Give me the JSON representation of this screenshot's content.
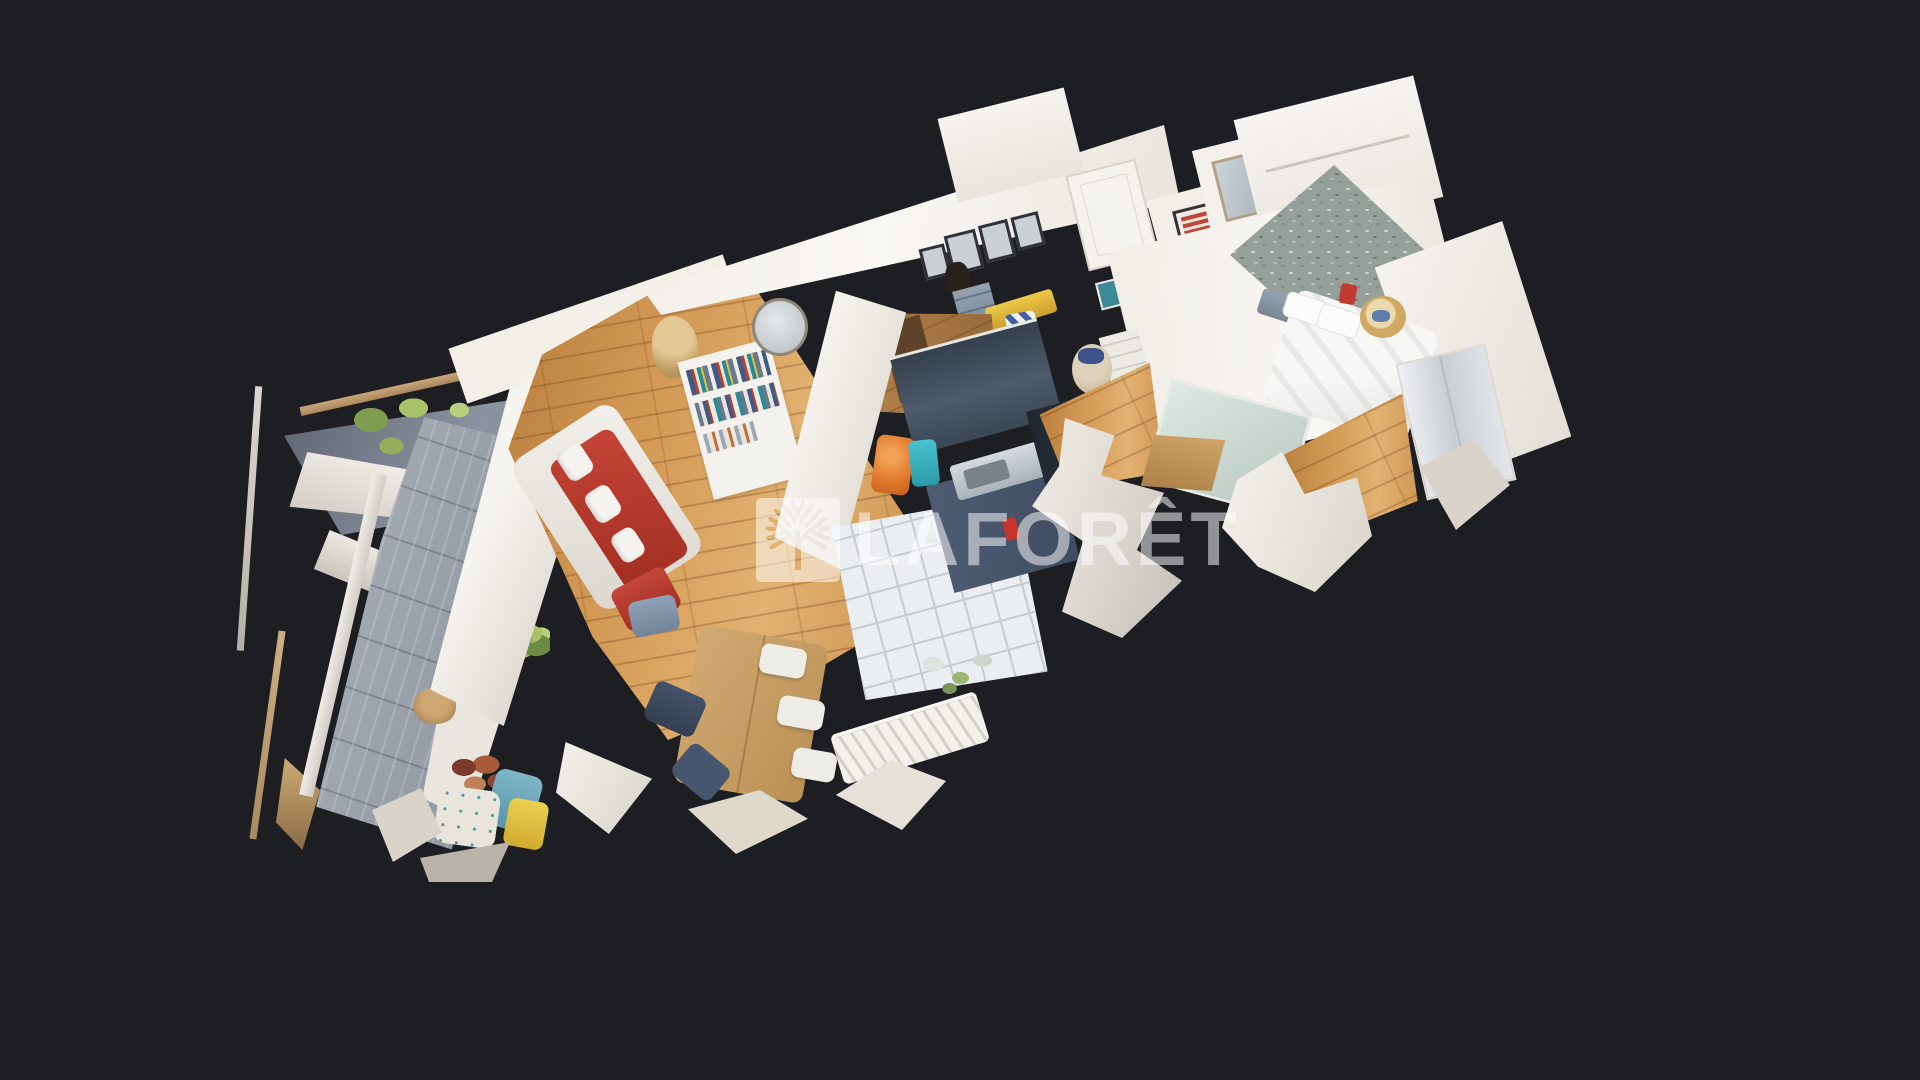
{
  "viewer": {
    "type": "3d-dollhouse-apartment-scan",
    "background_color": "#1d1e22"
  },
  "watermark": {
    "brand_text": "LAFORÊT",
    "icon": "laforet-tree-logo",
    "color": "#ffffff",
    "opacity": 0.52
  },
  "scene": {
    "rooms": [
      "balcony",
      "living-room",
      "dining-area",
      "kitchen",
      "hallway",
      "bathroom",
      "bedroom",
      "master-bedroom"
    ],
    "palette": {
      "background": "#1d1e22",
      "wall_white": "#f2efe9",
      "wood_floor": "#cf9a54",
      "deck_gray": "#9aa1aa",
      "awning_slate": "#7c8490",
      "kitchen_cabinet_navy": "#44505f",
      "tile_floor": "#eaeef1",
      "sofa_red": "#b5332a",
      "bench_yellow": "#e2bd3c",
      "mosaic_wall_green": "#95a09a",
      "terracotta_pot": "#c1703f",
      "plant_green": "#7f9c4f",
      "table_wood": "#d2aa72",
      "towel_blue": "#7fb6c8",
      "bag_orange": "#e0772a",
      "bag_teal": "#3ab6c4",
      "stripe_blue": "#3f5fa0",
      "bed_duvet": "#f7f7f5"
    }
  }
}
